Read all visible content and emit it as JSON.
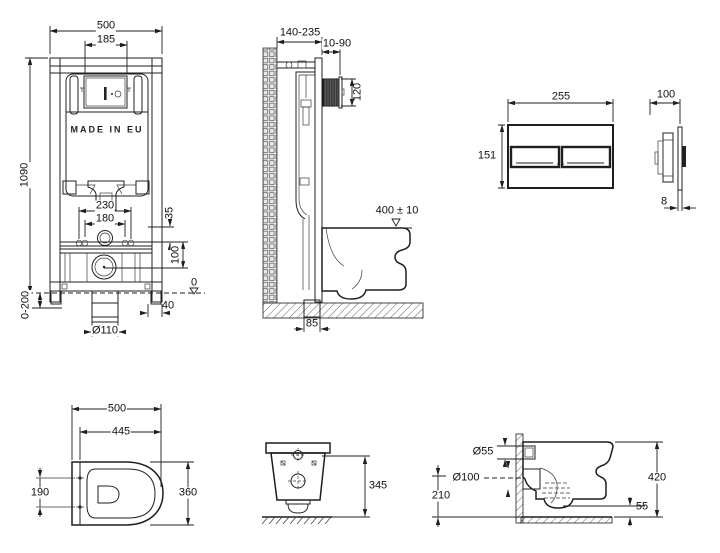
{
  "document": {
    "type": "technical-installation-drawing",
    "subject": "wall-hung toilet concealed frame, flush plate and bowl dimensions",
    "line_color": "#1f1f1f",
    "background": "#ffffff"
  },
  "views": {
    "frame_front": {
      "title": "frame-front-view",
      "labels": {
        "overall_width": "500",
        "access_width": "185",
        "overall_height": "1090",
        "brand_mark": "MADE IN EU",
        "fixing_outer": "230",
        "fixing_inner": "180",
        "inlet_offset": "35",
        "outlet_drop": "100",
        "floor_level": "0",
        "foot_width": "40",
        "drain_diameter": "Ø110",
        "foot_adjust": "0-200"
      }
    },
    "frame_side": {
      "title": "frame-side-view",
      "labels": {
        "depth_range": "140-235",
        "finish_range": "10-90",
        "box_height": "120",
        "bowl_height_tol": "400 ± 10",
        "outlet_offset": "85"
      }
    },
    "flush_plate_front": {
      "title": "flush-plate-front-view",
      "labels": {
        "width": "255",
        "height": "151"
      }
    },
    "flush_plate_side": {
      "title": "flush-plate-side-view",
      "labels": {
        "depth": "100",
        "thickness": "8"
      }
    },
    "bowl_top": {
      "title": "bowl-top-view",
      "labels": {
        "length": "500",
        "inner_length": "445",
        "hole_spacing": "190",
        "width": "360"
      }
    },
    "bowl_front": {
      "title": "bowl-front-view",
      "labels": {
        "height": "345"
      }
    },
    "bowl_side": {
      "title": "bowl-side-view",
      "labels": {
        "inlet_diameter": "Ø55",
        "outlet_diameter": "Ø100",
        "outlet_height": "210",
        "height": "420",
        "clearance": "55"
      }
    }
  }
}
